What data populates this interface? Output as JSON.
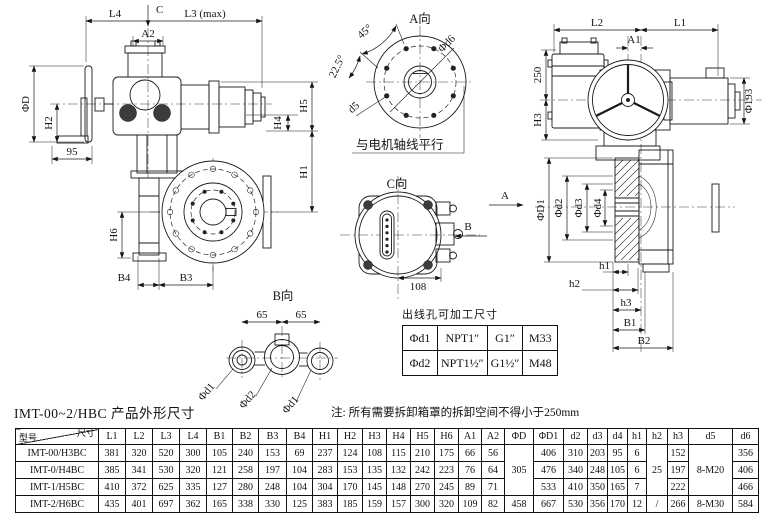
{
  "caption": "IMT-00~2/HBC 产品外形尺寸",
  "note": "注: 所有需要拆卸箱罩的拆卸空间不得小于250mm",
  "labels": {
    "l4": "L4",
    "c": "C",
    "l3": "L3 (max)",
    "a2": "A2",
    "phiD": "ΦD",
    "h2": "H2",
    "n95": "95",
    "h5": "H5",
    "h4": "H4",
    "h1": "H1",
    "h6": "H6",
    "b4": "B4",
    "b3": "B3",
    "aTitle": "A向",
    "deg45": "45°",
    "deg225": "22.5°",
    "phid6": "Φd6",
    "d5": "d5",
    "motorNote": "与电机轴线平行",
    "l2": "L2",
    "l1": "L1",
    "a1": "A1",
    "n250": "250",
    "h3": "H3",
    "phi193": "Φ193",
    "phiD1": "ΦD1",
    "phid2": "Φd2",
    "phid3": "Φd3",
    "phid4": "Φd4",
    "sh1": "h1",
    "sh2": "h2",
    "sh3": "h3",
    "b1": "B1",
    "b2": "B2",
    "dirA": "A",
    "dirB": "B",
    "cTitle": "C向",
    "n108": "108",
    "bTitle": "B向",
    "n65": "65",
    "bphid1": "Φd1",
    "bphid2": "Φd2"
  },
  "cable_table": {
    "title": "出线孔可加工尺寸",
    "rows": [
      [
        "Φd1",
        "NPT1″",
        "G1″",
        "M33"
      ],
      [
        "Φd2",
        "NPT1½″",
        "G1½″",
        "M48"
      ]
    ]
  },
  "dim_table": {
    "corner": {
      "size_label": "尺寸",
      "model_label": "型号"
    },
    "headers": [
      "L1",
      "L2",
      "L3",
      "L4",
      "B1",
      "B2",
      "B3",
      "B4",
      "H1",
      "H2",
      "H3",
      "H4",
      "H5",
      "H6",
      "A1",
      "A2",
      "ΦD",
      "ΦD1",
      "d2",
      "d3",
      "d4",
      "h1",
      "h2",
      "h3",
      "d5",
      "d6"
    ],
    "rows": [
      {
        "model": "IMT-00/H3BC",
        "cells": [
          "381",
          "320",
          "520",
          "300",
          "105",
          "240",
          "153",
          "69",
          "237",
          "124",
          "108",
          "115",
          "210",
          "175",
          "66",
          "56",
          {
            "v": "305",
            "rs": 3
          },
          "406",
          "310",
          "203",
          "95",
          "6",
          {
            "v": "25",
            "rs": 3
          },
          "152",
          {
            "v": "8-M20",
            "rs": 3
          },
          "356"
        ]
      },
      {
        "model": "IMT-0/H4BC",
        "cells": [
          "385",
          "341",
          "530",
          "320",
          "121",
          "258",
          "197",
          "104",
          "283",
          "153",
          "135",
          "132",
          "242",
          "223",
          "76",
          "64",
          null,
          "476",
          "340",
          "248",
          "105",
          "6",
          null,
          "197",
          null,
          "406"
        ]
      },
      {
        "model": "IMT-1/H5BC",
        "cells": [
          "410",
          "372",
          "625",
          "335",
          "127",
          "280",
          "248",
          "104",
          "304",
          "170",
          "145",
          "148",
          "270",
          "245",
          "89",
          "71",
          null,
          "533",
          "410",
          "350",
          "165",
          "7",
          null,
          "222",
          null,
          "466"
        ]
      },
      {
        "model": "IMT-2/H6BC",
        "cells": [
          "435",
          "401",
          "697",
          "362",
          "165",
          "338",
          "330",
          "125",
          "383",
          "185",
          "159",
          "157",
          "300",
          "320",
          "109",
          "82",
          "458",
          "667",
          "530",
          "356",
          "170",
          "12",
          "/",
          "266",
          "8-M30",
          "584"
        ]
      }
    ]
  }
}
